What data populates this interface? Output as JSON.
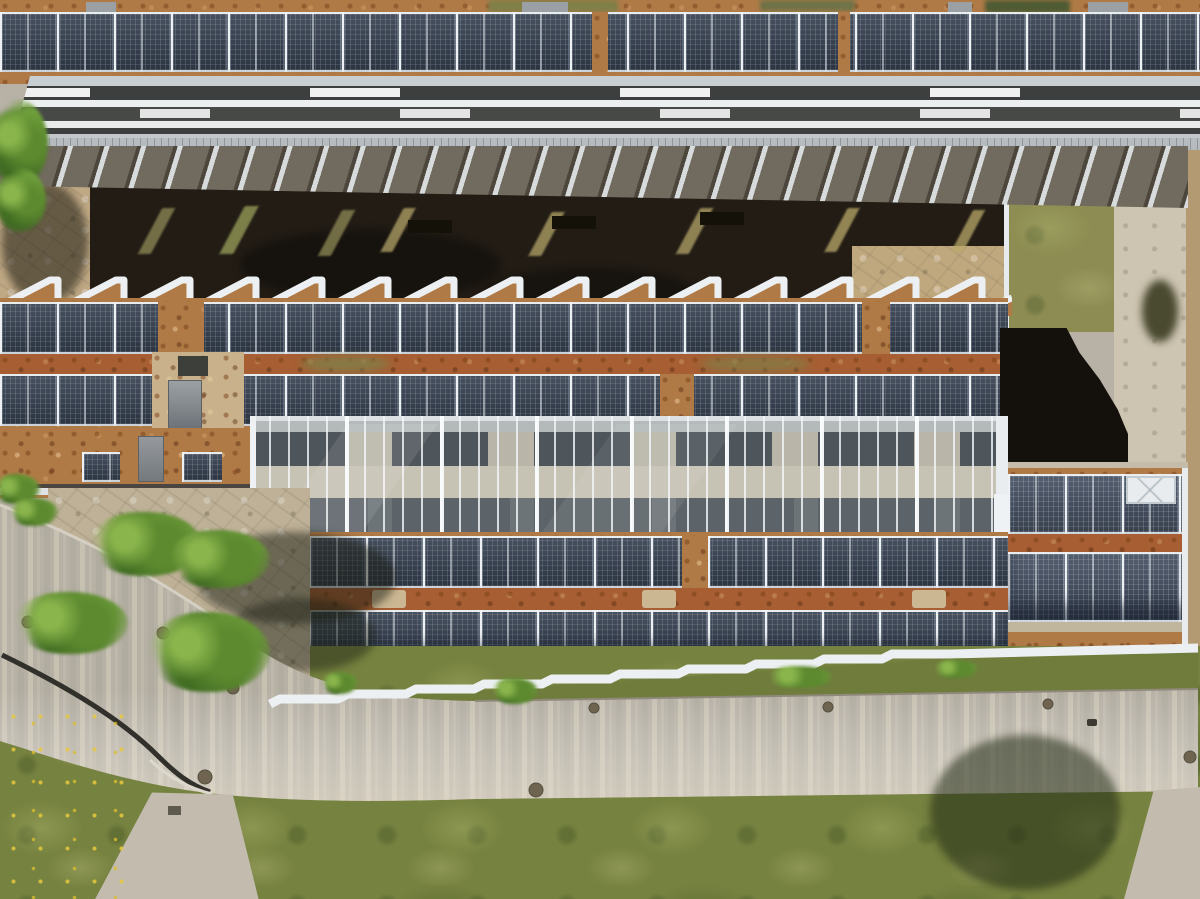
{
  "scene": {
    "type": "aerial-drone-photograph",
    "description": "Top-down aerial view of a large flat-roofed institute building covered with rows of photovoltaic solar panels, a long glazed atrium skylight, white sawtooth roof edges, a louvered canopy shading an inner courtyard, green-roof and gravel strips, and a curving access road with trees, lawns and footpaths below.",
    "lighting": "bright midday sun, hard shadows",
    "features": [
      "rooftop solar panel arrays in long rows",
      "glazed atrium skylight with white mullions",
      "white sawtooth roof edges",
      "louvered canopy over dark shaded courtyard",
      "green roof patch and gravel maintenance paths",
      "curved asphalt access road with guardrail",
      "footpaths branching from road",
      "lawns with dandelions and deciduous trees",
      "HVAC cabinets, roof hatches and skylight box",
      "manhole covers on asphalt",
      "blue container at building edge"
    ]
  },
  "counts": {
    "solar_panel_rows": 7,
    "sawtooth_teeth_top": 16,
    "roof_edge_steps_bottom": 10,
    "trees": 5,
    "manhole_covers": 9,
    "courtyard_benches": 3
  },
  "palette": {
    "gravel_roof": "#b07a46",
    "gravel_strip_red": "#a65e32",
    "gravel_pale": "#c9b28b",
    "path_gravel": "#cdc4b1",
    "panel_dark": "#353f4d",
    "courtyard": "#221c15",
    "courtyard_pavers": "#bfa884",
    "plaza_pavers": "#beb197",
    "green_roof": "#8d8c52",
    "green_strip": "#6f7c3c",
    "shadow_dark": "#14110c",
    "grass": "#76823f",
    "road": "#b6b0a5",
    "path": "#c3bcae",
    "sawtooth_white": "#edf0f2",
    "skylight_white": "#e8ecef",
    "bin_blue": "#3f6eaa",
    "sedum_green": "#7f7f48"
  }
}
